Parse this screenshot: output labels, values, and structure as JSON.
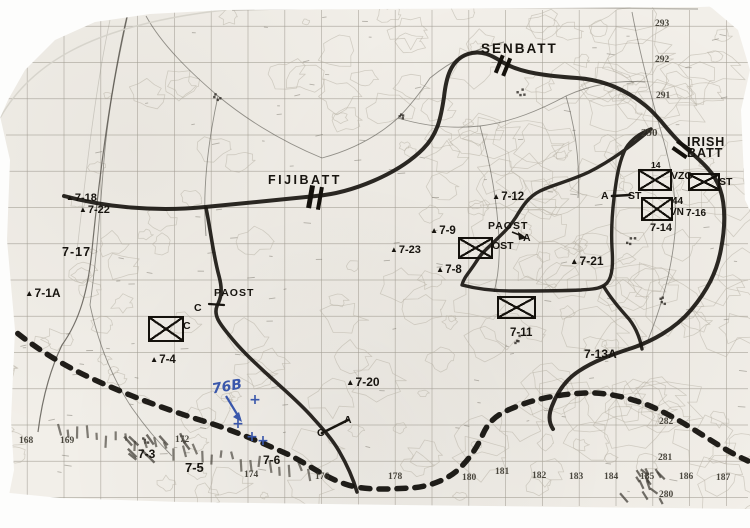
{
  "title": "Scanned tactical operations map with battalion sectors",
  "colors": {
    "paper": "#f2efe9",
    "ink": "#17140f",
    "blue_ink": "#3a57ab",
    "grid": "#a19c92"
  },
  "map_labels": [
    {
      "id": "fijibatt",
      "category": "unit",
      "text": "FIJIBATT",
      "x": 268,
      "y": 174,
      "s": 12.5,
      "ls": 2.5,
      "w": 800
    },
    {
      "id": "senbatt",
      "category": "unit",
      "text": "SENBATT",
      "x": 481,
      "y": 42,
      "s": 13.5,
      "ls": 2,
      "w": 800
    },
    {
      "id": "irishbatt-line1",
      "category": "unit",
      "text": "IRISH",
      "x": 687,
      "y": 136,
      "s": 12.5,
      "ls": 1,
      "w": 800
    },
    {
      "id": "irishbatt-line2",
      "category": "unit",
      "text": "BATT",
      "x": 687,
      "y": 147,
      "s": 12.5,
      "ls": 1,
      "w": 800
    },
    {
      "id": "paost-east",
      "category": "post",
      "text": "PAOST",
      "x": 488,
      "y": 221,
      "s": 10.5,
      "ls": 1,
      "w": 800
    },
    {
      "id": "company-a-east",
      "category": "company",
      "text": "A",
      "x": 523,
      "y": 233,
      "s": 10.5,
      "w": 800
    },
    {
      "id": "ost",
      "category": "post",
      "text": "OST",
      "x": 492,
      "y": 241,
      "s": 10.5,
      "w": 800
    },
    {
      "id": "paost-west",
      "category": "post",
      "text": "PAOST",
      "x": 214,
      "y": 288,
      "s": 10.5,
      "ls": 1,
      "w": 800
    },
    {
      "id": "company-c-west-1",
      "category": "company",
      "text": "C",
      "x": 194,
      "y": 303,
      "s": 10.5,
      "w": 800
    },
    {
      "id": "company-c-west-2",
      "category": "company",
      "text": "C",
      "x": 183,
      "y": 321,
      "s": 10.5,
      "w": 800
    },
    {
      "id": "company-a-boundary",
      "category": "company",
      "text": "A",
      "x": 601,
      "y": 191,
      "s": 10.5,
      "w": 800
    },
    {
      "id": "company-st-boundary",
      "category": "company",
      "text": "ST",
      "x": 628,
      "y": 191,
      "s": 10.5,
      "w": 800
    },
    {
      "id": "vzg",
      "category": "post",
      "text": "VZG",
      "x": 671,
      "y": 171,
      "s": 10.5,
      "w": 800
    },
    {
      "id": "st-box",
      "category": "post",
      "text": "ST",
      "x": 719,
      "y": 177,
      "s": 10.5,
      "w": 800
    },
    {
      "id": "number-14",
      "category": "post",
      "text": "14",
      "x": 651,
      "y": 161,
      "s": 8.5,
      "w": 700
    },
    {
      "id": "number-44",
      "category": "post",
      "text": "44",
      "x": 672,
      "y": 197,
      "s": 10,
      "w": 800
    },
    {
      "id": "vn",
      "category": "post",
      "text": "VN",
      "x": 670,
      "y": 208,
      "s": 10,
      "w": 800
    },
    {
      "id": "position-7-16",
      "category": "position",
      "text": "7-16",
      "x": 686,
      "y": 209,
      "s": 10,
      "w": 800
    },
    {
      "id": "position-7-14",
      "category": "position",
      "text": "7-14",
      "x": 650,
      "y": 223,
      "s": 11,
      "w": 800
    },
    {
      "id": "position-7-18",
      "category": "position",
      "text": "7-18",
      "x": 66,
      "y": 193,
      "s": 11,
      "w": 800,
      "tri": true
    },
    {
      "id": "position-7-22",
      "category": "position",
      "text": "7-22",
      "x": 79,
      "y": 205,
      "s": 11,
      "w": 800,
      "tri": true
    },
    {
      "id": "position-7-17",
      "category": "position",
      "text": "7-17",
      "x": 62,
      "y": 246,
      "s": 12.5,
      "ls": 1,
      "w": 800
    },
    {
      "id": "position-7-1A",
      "category": "position",
      "text": "7-1A",
      "x": 25,
      "y": 287,
      "s": 12,
      "w": 800,
      "tri": true
    },
    {
      "id": "position-7-12",
      "category": "position",
      "text": "7-12",
      "x": 492,
      "y": 192,
      "s": 11.5,
      "w": 800,
      "tri": true
    },
    {
      "id": "position-7-9",
      "category": "position",
      "text": "7-9",
      "x": 430,
      "y": 226,
      "s": 11.5,
      "w": 800,
      "tri": true
    },
    {
      "id": "position-7-23",
      "category": "position",
      "text": "7-23",
      "x": 390,
      "y": 245,
      "s": 11,
      "w": 800,
      "tri": true
    },
    {
      "id": "position-7-8",
      "category": "position",
      "text": "7-8",
      "x": 436,
      "y": 265,
      "s": 11.5,
      "w": 800,
      "tri": true
    },
    {
      "id": "position-7-21",
      "category": "position",
      "text": "7-21",
      "x": 570,
      "y": 255,
      "s": 12,
      "w": 800,
      "tri": true
    },
    {
      "id": "position-7-11",
      "category": "position",
      "text": "7-11",
      "x": 510,
      "y": 328,
      "s": 11.5,
      "w": 800
    },
    {
      "id": "position-7-13A",
      "category": "position",
      "text": "7-13A",
      "x": 584,
      "y": 348,
      "s": 12,
      "w": 800
    },
    {
      "id": "position-7-4",
      "category": "position",
      "text": "7-4",
      "x": 150,
      "y": 355,
      "s": 11.5,
      "w": 800,
      "tri": true
    },
    {
      "id": "position-7-20",
      "category": "position",
      "text": "7-20",
      "x": 346,
      "y": 376,
      "s": 12,
      "w": 800,
      "tri": true
    },
    {
      "id": "position-7-3",
      "category": "position",
      "text": "7-3",
      "x": 138,
      "y": 448,
      "s": 12,
      "w": 800
    },
    {
      "id": "position-7-5",
      "category": "position",
      "text": "7-5",
      "x": 185,
      "y": 461,
      "s": 13,
      "w": 800
    },
    {
      "id": "position-7-6",
      "category": "position",
      "text": "7-6",
      "x": 263,
      "y": 454,
      "s": 12,
      "w": 800
    },
    {
      "id": "company-c-tick",
      "category": "company",
      "text": "C",
      "x": 317,
      "y": 428,
      "s": 10.5,
      "w": 800
    },
    {
      "id": "company-a-tick",
      "category": "company",
      "text": "A",
      "x": 344,
      "y": 415,
      "s": 10.5,
      "w": 800
    }
  ],
  "grid_numbers": [
    {
      "text": "168",
      "x": 19,
      "y": 437
    },
    {
      "text": "169",
      "x": 60,
      "y": 437
    },
    {
      "text": "172",
      "x": 175,
      "y": 436
    },
    {
      "text": "174",
      "x": 244,
      "y": 471
    },
    {
      "text": "176",
      "x": 315,
      "y": 473
    },
    {
      "text": "178",
      "x": 388,
      "y": 473
    },
    {
      "text": "180",
      "x": 462,
      "y": 474
    },
    {
      "text": "181",
      "x": 495,
      "y": 468
    },
    {
      "text": "182",
      "x": 532,
      "y": 472
    },
    {
      "text": "183",
      "x": 569,
      "y": 473
    },
    {
      "text": "184",
      "x": 604,
      "y": 473
    },
    {
      "text": "185",
      "x": 640,
      "y": 473
    },
    {
      "text": "186",
      "x": 679,
      "y": 473
    },
    {
      "text": "187",
      "x": 716,
      "y": 474
    },
    {
      "text": "280",
      "x": 659,
      "y": 491
    },
    {
      "text": "281",
      "x": 658,
      "y": 454
    },
    {
      "text": "282",
      "x": 659,
      "y": 418
    },
    {
      "text": "290",
      "x": 641,
      "y": 128,
      "s": 11
    },
    {
      "text": "291",
      "x": 656,
      "y": 92
    },
    {
      "text": "292",
      "x": 655,
      "y": 56
    },
    {
      "text": "293",
      "x": 655,
      "y": 20
    }
  ],
  "unit_symbols": [
    {
      "id": "vzg-box",
      "x": 638,
      "y": 169,
      "w": 34,
      "h": 22
    },
    {
      "id": "st-box-symbol",
      "x": 688,
      "y": 173,
      "w": 32,
      "h": 18
    },
    {
      "id": "44-vn-box",
      "x": 641,
      "y": 197,
      "w": 32,
      "h": 24
    },
    {
      "id": "ost-box",
      "x": 458,
      "y": 237,
      "w": 35,
      "h": 22
    },
    {
      "id": "a-box",
      "x": 497,
      "y": 296,
      "w": 39,
      "h": 23
    },
    {
      "id": "c-box",
      "x": 148,
      "y": 316,
      "w": 36,
      "h": 26
    }
  ],
  "echelon_markers": [
    {
      "id": "echelon-fijibatt",
      "x": 308,
      "y": 186,
      "h": 23,
      "bw": 4.5,
      "gap": 5,
      "rot": 10
    },
    {
      "id": "echelon-senbatt",
      "x": 497,
      "y": 56,
      "h": 19,
      "bw": 3.5,
      "gap": 4.5,
      "rot": 22
    },
    {
      "id": "echelon-irishbatt",
      "x": 676,
      "y": 141,
      "h": 17,
      "bw": 3.5,
      "gap": 4.5,
      "rot": -55
    }
  ],
  "handwritten": {
    "text": "76B",
    "x": 212,
    "y": 380,
    "size": 14,
    "rotation": -10,
    "arrow": {
      "x1": 226,
      "y1": 396,
      "x2": 240,
      "y2": 419
    },
    "crosses": [
      [
        255,
        400
      ],
      [
        238,
        424
      ],
      [
        252,
        437
      ],
      [
        263,
        441
      ]
    ]
  }
}
